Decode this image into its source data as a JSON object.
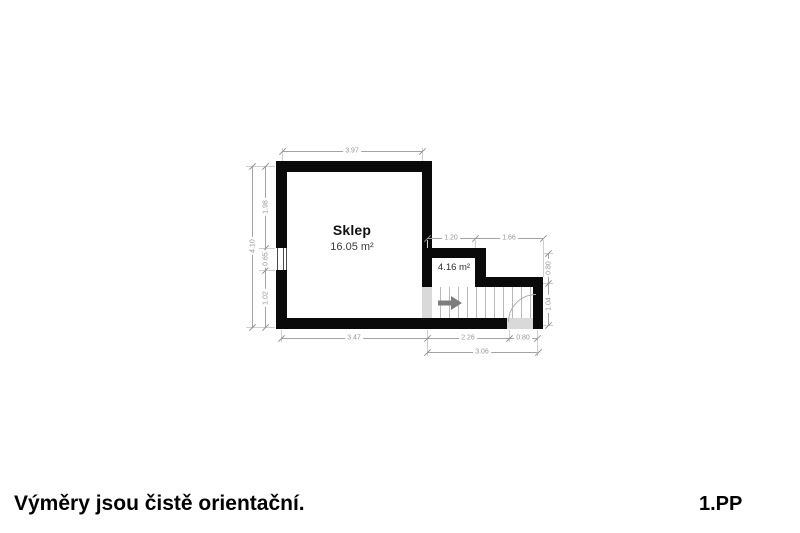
{
  "footer": {
    "disclaimer": "Výměry jsou čistě orientační.",
    "floor_label": "1.PP"
  },
  "rooms": [
    {
      "name": "Sklep",
      "area": "16.05 m²"
    },
    {
      "name": "",
      "area": "4.16 m²"
    }
  ],
  "dimensions": {
    "top_width": "3.97",
    "left_total": "4.10",
    "left_segments": [
      "1.98",
      "0.65",
      "1.02"
    ],
    "upper_right": [
      "1.20",
      "1.66"
    ],
    "right_segments": [
      "0.80",
      "1.04"
    ],
    "bottom_segments": [
      "3.47",
      "2.26",
      "0.80"
    ],
    "bottom_total": "3.06"
  },
  "colors": {
    "wall": "#0a0a0a",
    "dimension_text": "#979797",
    "stair_lines": "#b8b8b8",
    "threshold": "#d9d9d9",
    "arrow": "#7d7d7d"
  }
}
